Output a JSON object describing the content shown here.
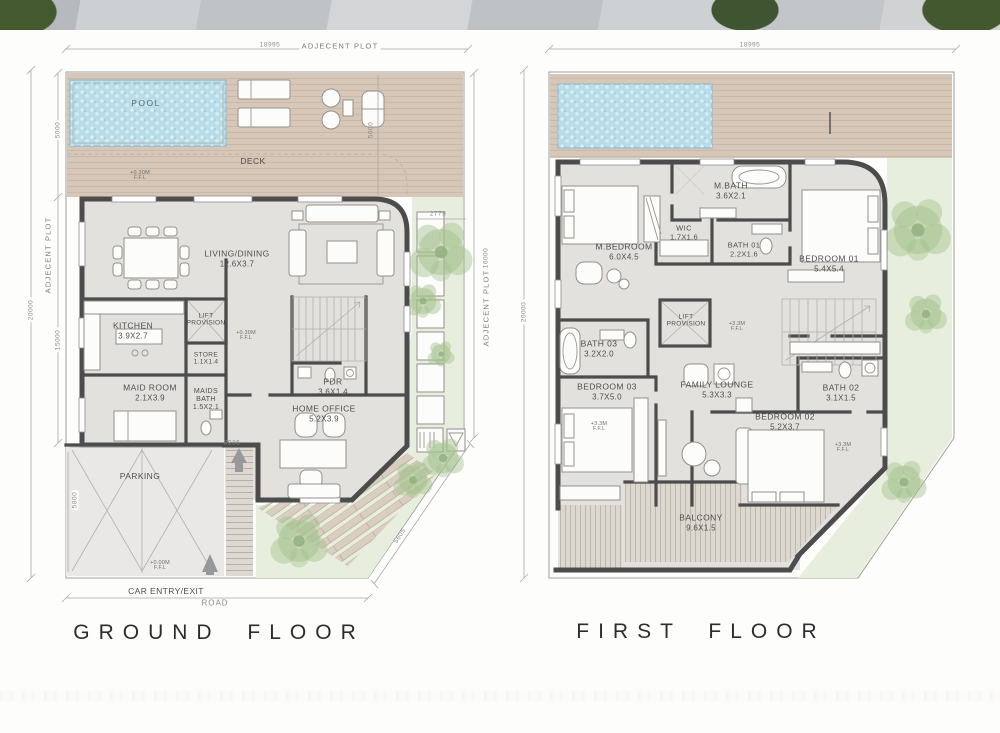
{
  "colors": {
    "wall": "#4c4c4c",
    "floor": "#e3e1de",
    "deck": "#d7c7b8",
    "pool": "#b7dde8",
    "landscape": "#e8eedd",
    "tree": "#a3c18e",
    "line": "#9e9e9e",
    "dimtext": "#8a8a8a",
    "label": "#4f4f4f",
    "title": "#2d2d2d"
  },
  "page": {
    "ground_title": "GROUND FLOOR",
    "first_title": "FIRST FLOOR"
  },
  "ground": {
    "dims": {
      "top_plot": "ADJECENT PLOT",
      "top_len": "18995",
      "left_plot": "ADJECENT PLOT",
      "left_len": "20000",
      "left_pool": "5000",
      "left_mid": "15000",
      "left_parking": "5800",
      "right_plot": "ADJECENT PLOT",
      "right_len": "16000",
      "right_deck": "5000",
      "right_offset": "2779",
      "diag": "5605",
      "parking_width": "8936",
      "road": "ROAD"
    },
    "rooms": {
      "pool": {
        "name": "POOL"
      },
      "deck": {
        "name": "DECK"
      },
      "living": {
        "name": "LIVING/DINING",
        "dims": "12.6X3.7"
      },
      "kitchen": {
        "name": "KITCHEN",
        "dims": "3.9X2.7"
      },
      "lift": {
        "name": "LIFT",
        "name2": "PROVISION"
      },
      "store": {
        "name": "STORE",
        "dims": "1.1X1.4"
      },
      "maid": {
        "name": "MAID ROOM",
        "dims": "2.1X3.9"
      },
      "maids_bath": {
        "name": "MAIDS BATH",
        "dims": "1.5X2.1"
      },
      "pdr": {
        "name": "PDR",
        "dims": "3.6X1.4"
      },
      "home_office": {
        "name": "HOME OFFICE",
        "dims": "5.2X3.9"
      },
      "parking": {
        "name": "PARKING"
      },
      "car_entry": {
        "name": "CAR ENTRY/EXIT"
      }
    },
    "markers": {
      "deck": {
        "value": "+0.30M",
        "suffix": "F.F.L"
      },
      "living": {
        "value": "+0.30M",
        "suffix": "F.F.L"
      },
      "entry": {
        "value": "+0.00M",
        "suffix": "F.F.L"
      }
    }
  },
  "first": {
    "dims": {
      "top_len": "18995",
      "left_len": "20000"
    },
    "rooms": {
      "m_bedroom": {
        "name": "M.BEDROOM",
        "dims": "6.0X4.5"
      },
      "wic": {
        "name": "WIC",
        "dims": "1.7X1.6"
      },
      "m_bath": {
        "name": "M.BATH",
        "dims": "3.6X2.1"
      },
      "bath01": {
        "name": "BATH 01",
        "dims": "2.2X1.6"
      },
      "bedroom01": {
        "name": "BEDROOM 01",
        "dims": "5.4X5.4"
      },
      "lift": {
        "name": "LIFT",
        "name2": "PROVISION"
      },
      "bath03": {
        "name": "BATH 03",
        "dims": "3.2X2.0"
      },
      "bedroom03": {
        "name": "BEDROOM 03",
        "dims": "3.7X5.0"
      },
      "family_lounge": {
        "name": "FAMILY LOUNGE",
        "dims": "5.3X3.3"
      },
      "bath02": {
        "name": "BATH 02",
        "dims": "3.1X1.5"
      },
      "bedroom02": {
        "name": "BEDROOM 02",
        "dims": "5.2X3.7"
      },
      "balcony": {
        "name": "BALCONY",
        "dims": "9.6X1.5"
      }
    },
    "markers": {
      "hall": {
        "value": "+3.3M",
        "suffix": "F.F.L"
      },
      "bedroom03": {
        "value": "+3.3M",
        "suffix": "F.F.L"
      },
      "bedroom02": {
        "value": "+3.3M",
        "suffix": "F.F.L"
      }
    }
  }
}
